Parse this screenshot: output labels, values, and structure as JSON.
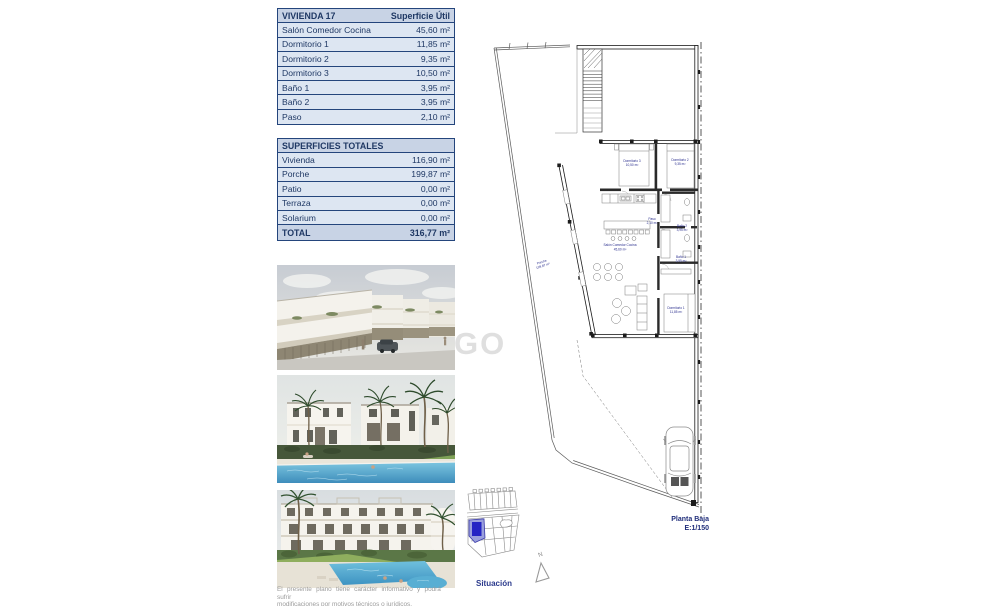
{
  "document": {
    "watermark": "GO"
  },
  "tables": {
    "vivienda": {
      "title": "VIVIENDA 17",
      "column_header": "Superficie Útil",
      "rows": [
        {
          "label": "Salón Comedor Cocina",
          "value": "45,60 m²"
        },
        {
          "label": "Dormitorio 1",
          "value": "11,85 m²"
        },
        {
          "label": "Dormitorio 2",
          "value": "9,35 m²"
        },
        {
          "label": "Dormitorio 3",
          "value": "10,50 m²"
        },
        {
          "label": "Baño 1",
          "value": "3,95 m²"
        },
        {
          "label": "Baño 2",
          "value": "3,95 m²"
        },
        {
          "label": "Paso",
          "value": "2,10 m²"
        }
      ]
    },
    "superficies": {
      "title": "SUPERFICIES TOTALES",
      "rows": [
        {
          "label": "Vivienda",
          "value": "116,90 m²"
        },
        {
          "label": "Porche",
          "value": "199,87 m²"
        },
        {
          "label": "Patio",
          "value": "0,00 m²"
        },
        {
          "label": "Terraza",
          "value": "0,00 m²"
        },
        {
          "label": "Solarium",
          "value": "0,00 m²"
        }
      ],
      "total": {
        "label": "TOTAL",
        "value": "316,77 m²"
      }
    }
  },
  "plan": {
    "rooms": [
      {
        "name": "Dormitorio 3",
        "area": "10,50 m²"
      },
      {
        "name": "Dormitorio 2",
        "area": "9,35 m²"
      },
      {
        "name": "Paso",
        "area": "2,10 m²"
      },
      {
        "name": "Baño 2",
        "area": "3,95 m²"
      },
      {
        "name": "Salón Comedor Cocina",
        "area": "45,60 m²"
      },
      {
        "name": "Baño 1",
        "area": "3,95 m²"
      },
      {
        "name": "Dormitorio 1",
        "area": "11,85 m²"
      },
      {
        "name": "Porche",
        "area": "199,87 m²"
      }
    ],
    "caption": {
      "line1": "Planta Baja",
      "line2": "E:1/150"
    },
    "north_label": "N"
  },
  "situacion": {
    "label": "Situación"
  },
  "disclaimer": {
    "line1": "El presente plano tiene carácter informativo y podrá sufrir",
    "line2": "modificaciones por motivos técnicos o jurídicos."
  },
  "colors": {
    "table_border": "#24457c",
    "table_header_bg": "#c8d3e5",
    "table_row_bg": "#dde6f2",
    "table_text": "#1f3864",
    "plan_label_blue": "#2b2f8e",
    "highlight_plot_blue": "#2424c4"
  }
}
